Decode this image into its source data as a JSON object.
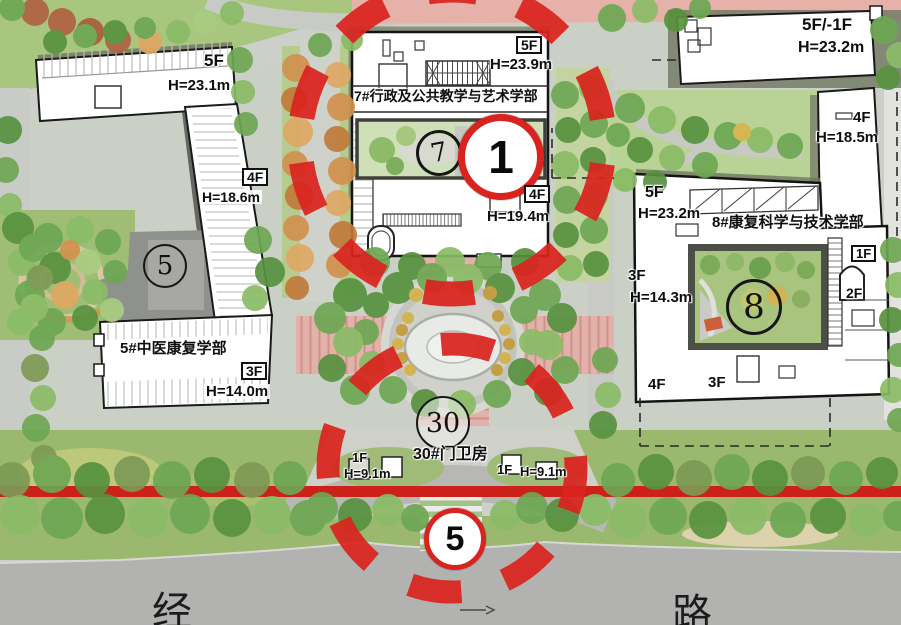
{
  "colors": {
    "highlight_red": "#d9231e",
    "paving_pink": "#e2b2aa",
    "building_fill": "#ffffff",
    "outline": "#1a1a1a"
  },
  "buildings": {
    "b5": {
      "badge": "5",
      "name": "5#中医康复学部",
      "main_floors": "3F",
      "main_height": "H=14.0m",
      "north_wing": {
        "floors": "5F",
        "height": "H=23.1m"
      },
      "east_wing": {
        "floors": "4F",
        "height": "H=18.6m"
      }
    },
    "b7": {
      "badge": "7",
      "name": "7#行政及公共教学与艺术学部",
      "north": {
        "floors": "5F",
        "height": "H=23.9m"
      },
      "south": {
        "floors": "4F",
        "height": "H=19.4m"
      }
    },
    "b8": {
      "badge": "8",
      "name": "8#康复科学与技术学部",
      "north": {
        "floors": "5F",
        "height": "H=23.2m"
      },
      "west": {
        "floors": "3F",
        "height": "H=14.3m"
      },
      "northeast_floors": "1F",
      "east_floors": "2F",
      "southwest_floors": "4F",
      "south_floors": "3F"
    },
    "northeast_building": {
      "floors": "5F/-1F",
      "height": "H=23.2m"
    },
    "east_building": {
      "floors": "4F",
      "height": "H=18.5m"
    },
    "gatehouse": {
      "badge": "30",
      "name": "30#门卫房",
      "west": {
        "floors": "1F",
        "height": "H=9.1m"
      },
      "east": {
        "floors": "1F",
        "height": "H=9.1m"
      }
    }
  },
  "markers": {
    "building_marker": "1",
    "gate_marker": "5"
  },
  "road": {
    "west_char": "经",
    "east_char": "路"
  }
}
